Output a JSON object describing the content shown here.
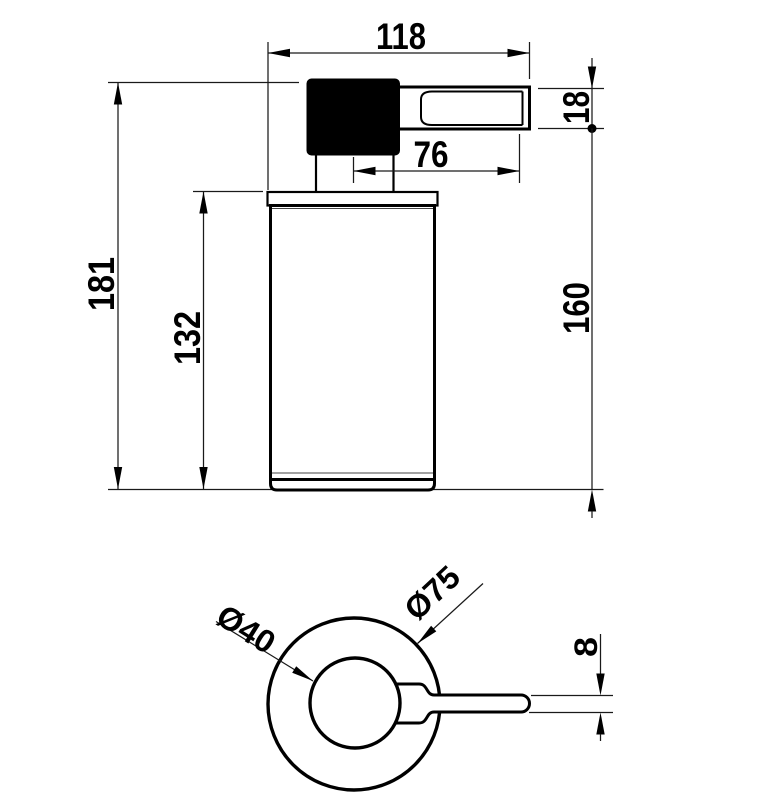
{
  "title": "soap-dispenser-technical-drawing",
  "colors": {
    "background": "#ffffff",
    "line": "#000000"
  },
  "dims": {
    "overall_width": "118",
    "spout_height": "18",
    "spout_length": "76",
    "total_height": "181",
    "body_height": "132",
    "pump_height": "160",
    "handle_thickness": "8",
    "inner_diameter": "Ø40",
    "outer_diameter": "Ø75"
  }
}
